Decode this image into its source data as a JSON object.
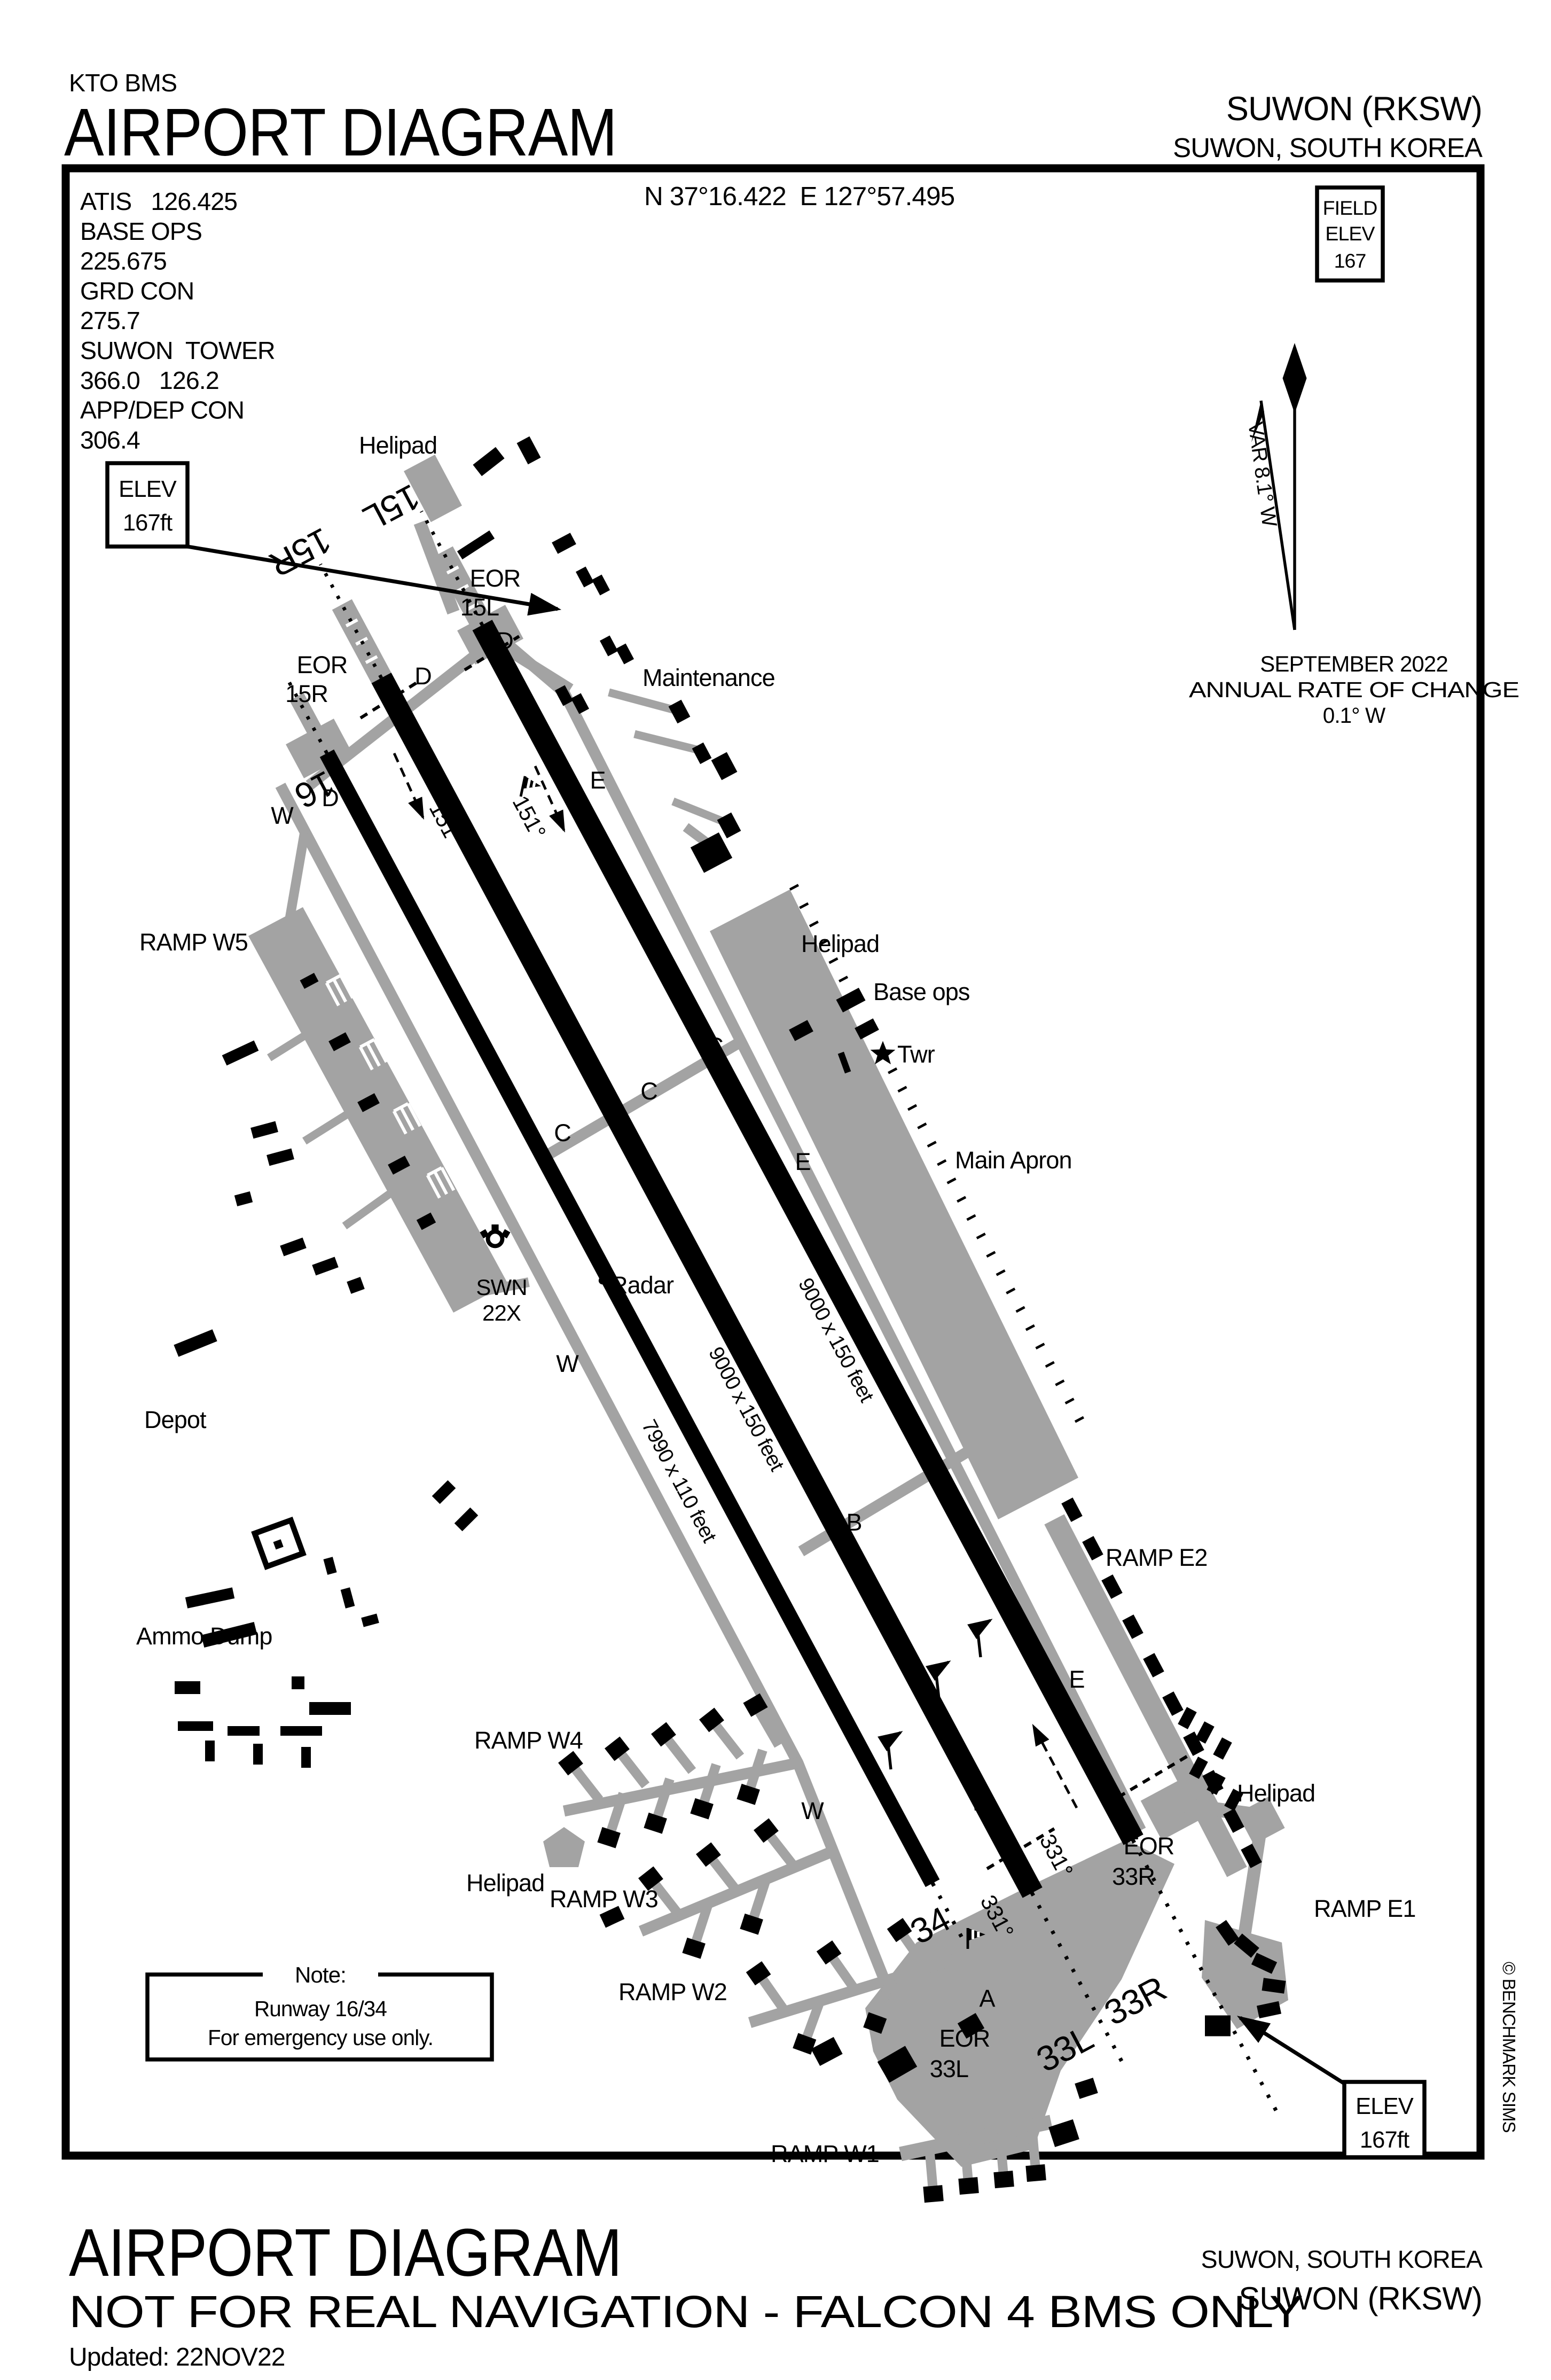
{
  "header": {
    "org": "KTO BMS",
    "title": "AIRPORT DIAGRAM",
    "airport": "SUWON (RKSW)",
    "location": "SUWON, SOUTH KOREA"
  },
  "footer": {
    "title": "AIRPORT DIAGRAM",
    "disclaimer": "NOT FOR REAL NAVIGATION - FALCON 4 BMS ONLY",
    "updated": "Updated: 22NOV22",
    "location": "SUWON, SOUTH KOREA",
    "airport": "SUWON (RKSW)"
  },
  "copyright": "© BENCHMARK SIMS",
  "info": {
    "comm": [
      "ATIS   126.425",
      "BASE OPS",
      "225.675",
      "GRD CON",
      "275.7",
      "SUWON  TOWER",
      "366.0   126.2",
      "APP/DEP CON",
      "306.4"
    ],
    "coordinates": "N 37°16.422  E 127°57.495",
    "field_elev": {
      "line1": "FIELD",
      "line2": "ELEV",
      "value": "167"
    },
    "elev_top": {
      "line1": "ELEV",
      "line2": "167ft"
    },
    "elev_bottom": {
      "line1": "ELEV",
      "line2": "167ft"
    },
    "variation": {
      "label": "VAR 8.1° W",
      "date": "SEPTEMBER 2022",
      "rate_label": "ANNUAL RATE OF CHANGE",
      "rate_value": "0.1° W"
    },
    "note": {
      "title": "Note:",
      "line1": "Runway 16/34",
      "line2": "For emergency use only."
    }
  },
  "runways": {
    "r15l33r": {
      "end1": "15L",
      "end2": "33R",
      "heading1": "151°",
      "heading2": "331°",
      "dim": "9000 x 150 feet"
    },
    "r15r33l": {
      "end1": "15R",
      "end2": "33L",
      "heading1": "151°",
      "heading2": "331°",
      "dim": "9000 x 150 feet"
    },
    "r1634": {
      "end1": "16",
      "end2": "34",
      "dim": "7990 x 110 feet"
    }
  },
  "labels": {
    "eor": "EOR",
    "helipad": "Helipad",
    "maintenance": "Maintenance",
    "ramp_w5": "RAMP W5",
    "ramp_w4": "RAMP W4",
    "ramp_w3": "RAMP W3",
    "ramp_w2": "RAMP W2",
    "ramp_w1": "RAMP W1",
    "ramp_e1": "RAMP E1",
    "ramp_e2": "RAMP E2",
    "base_ops": "Base ops",
    "twr": "Twr",
    "main_apron": "Main Apron",
    "radar": "Radar",
    "tacan_name": "SWN",
    "tacan_channel": "22X",
    "depot": "Depot",
    "ammo_dump": "Ammo Dump",
    "twy_a": "A",
    "twy_b": "B",
    "twy_c": "C",
    "twy_d": "D",
    "twy_e": "E",
    "twy_w": "W"
  },
  "colors": {
    "taxiway_gray": "#a3a3a3",
    "runway_black": "#000000",
    "background": "#ffffff"
  }
}
